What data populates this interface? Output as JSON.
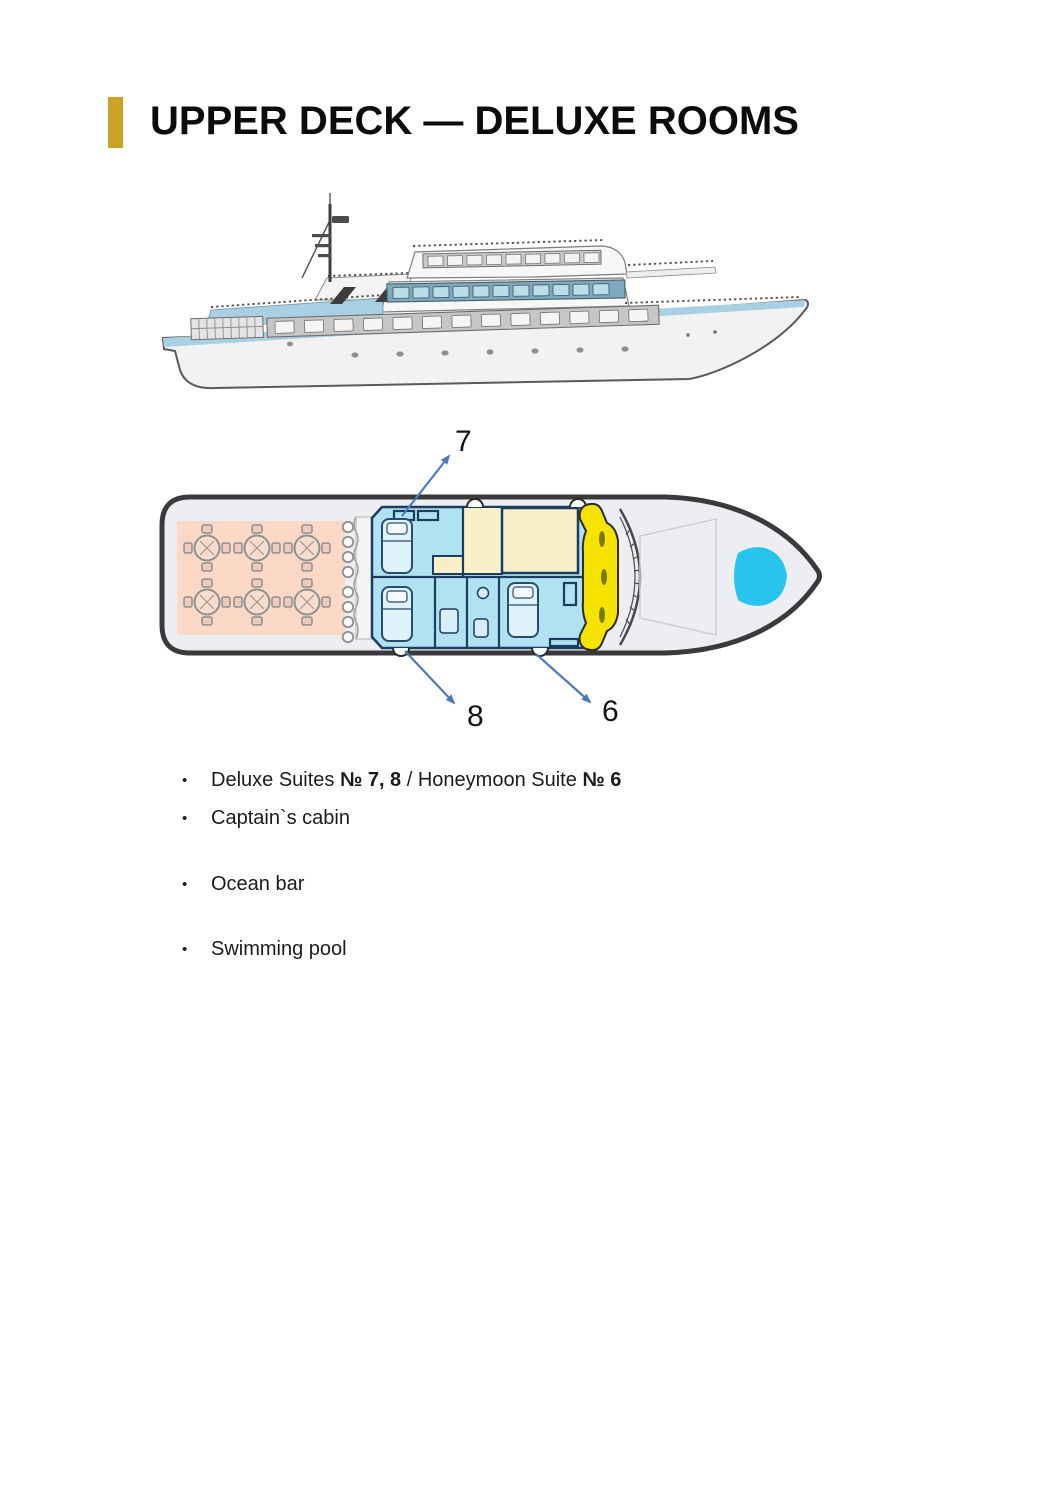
{
  "header": {
    "title": "UPPER DECK — DELUXE ROOMS",
    "accent_color": "#C9A227"
  },
  "yacht_illustration": {
    "name": "yacht-side-profile",
    "hull_color": "#F2F2F2",
    "sheer_stripe_color": "#A9CFE2",
    "cabin_band_color": "#7FA9BF",
    "window_color": "#BCDCE8"
  },
  "deck_plan": {
    "name": "upper-deck-floor-plan",
    "arrow_color": "#4A7CBA",
    "labels": [
      {
        "text": "7"
      },
      {
        "text": "8"
      },
      {
        "text": "6"
      }
    ],
    "colors": {
      "hull_fill": "#EDEEF1",
      "hull_outline": "#3A3A3C",
      "dining_area": "#FBD9C6",
      "suites": "#B0E2F2",
      "corridor": "#F9F0CA",
      "stairs": "#F6E300",
      "pool": "#27C5EE",
      "wall": "#1C3C60"
    }
  },
  "features": {
    "bullet_char": "•",
    "items": [
      {
        "parts": [
          {
            "text": "Deluxe Suites "
          },
          {
            "text": "№ 7, 8",
            "bold": true
          },
          {
            "text": " / Honeymoon Suite "
          },
          {
            "text": "№ 6",
            "bold": true
          }
        ]
      },
      {
        "parts": [
          {
            "text": "Captain`s cabin"
          }
        ]
      },
      {
        "parts": [
          {
            "text": "Ocean bar"
          }
        ]
      },
      {
        "parts": [
          {
            "text": "Swimming pool"
          }
        ]
      }
    ]
  }
}
